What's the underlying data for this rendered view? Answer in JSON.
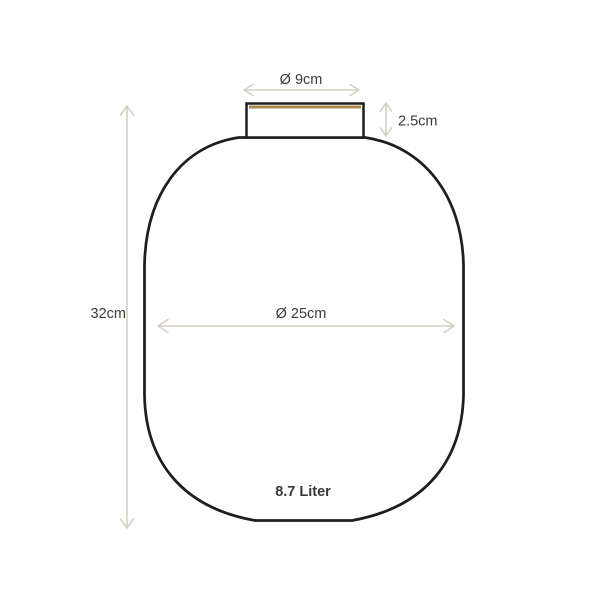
{
  "diagram": {
    "type": "product-dimension-diagram",
    "subject": "vase",
    "dimensions": {
      "opening_diameter": {
        "label": "Ø 9cm"
      },
      "neck_height": {
        "label": "2.5cm"
      },
      "total_height": {
        "label": "32cm"
      },
      "body_diameter": {
        "label": "Ø 25cm"
      },
      "capacity": {
        "label": "8.7 Liter"
      }
    },
    "colors": {
      "background": "#ffffff",
      "outline": "#1e1e1c",
      "gold_accent": "#a68c4e",
      "dimension_arrow": "#d4d0c3",
      "text": "#3a3a39"
    }
  }
}
